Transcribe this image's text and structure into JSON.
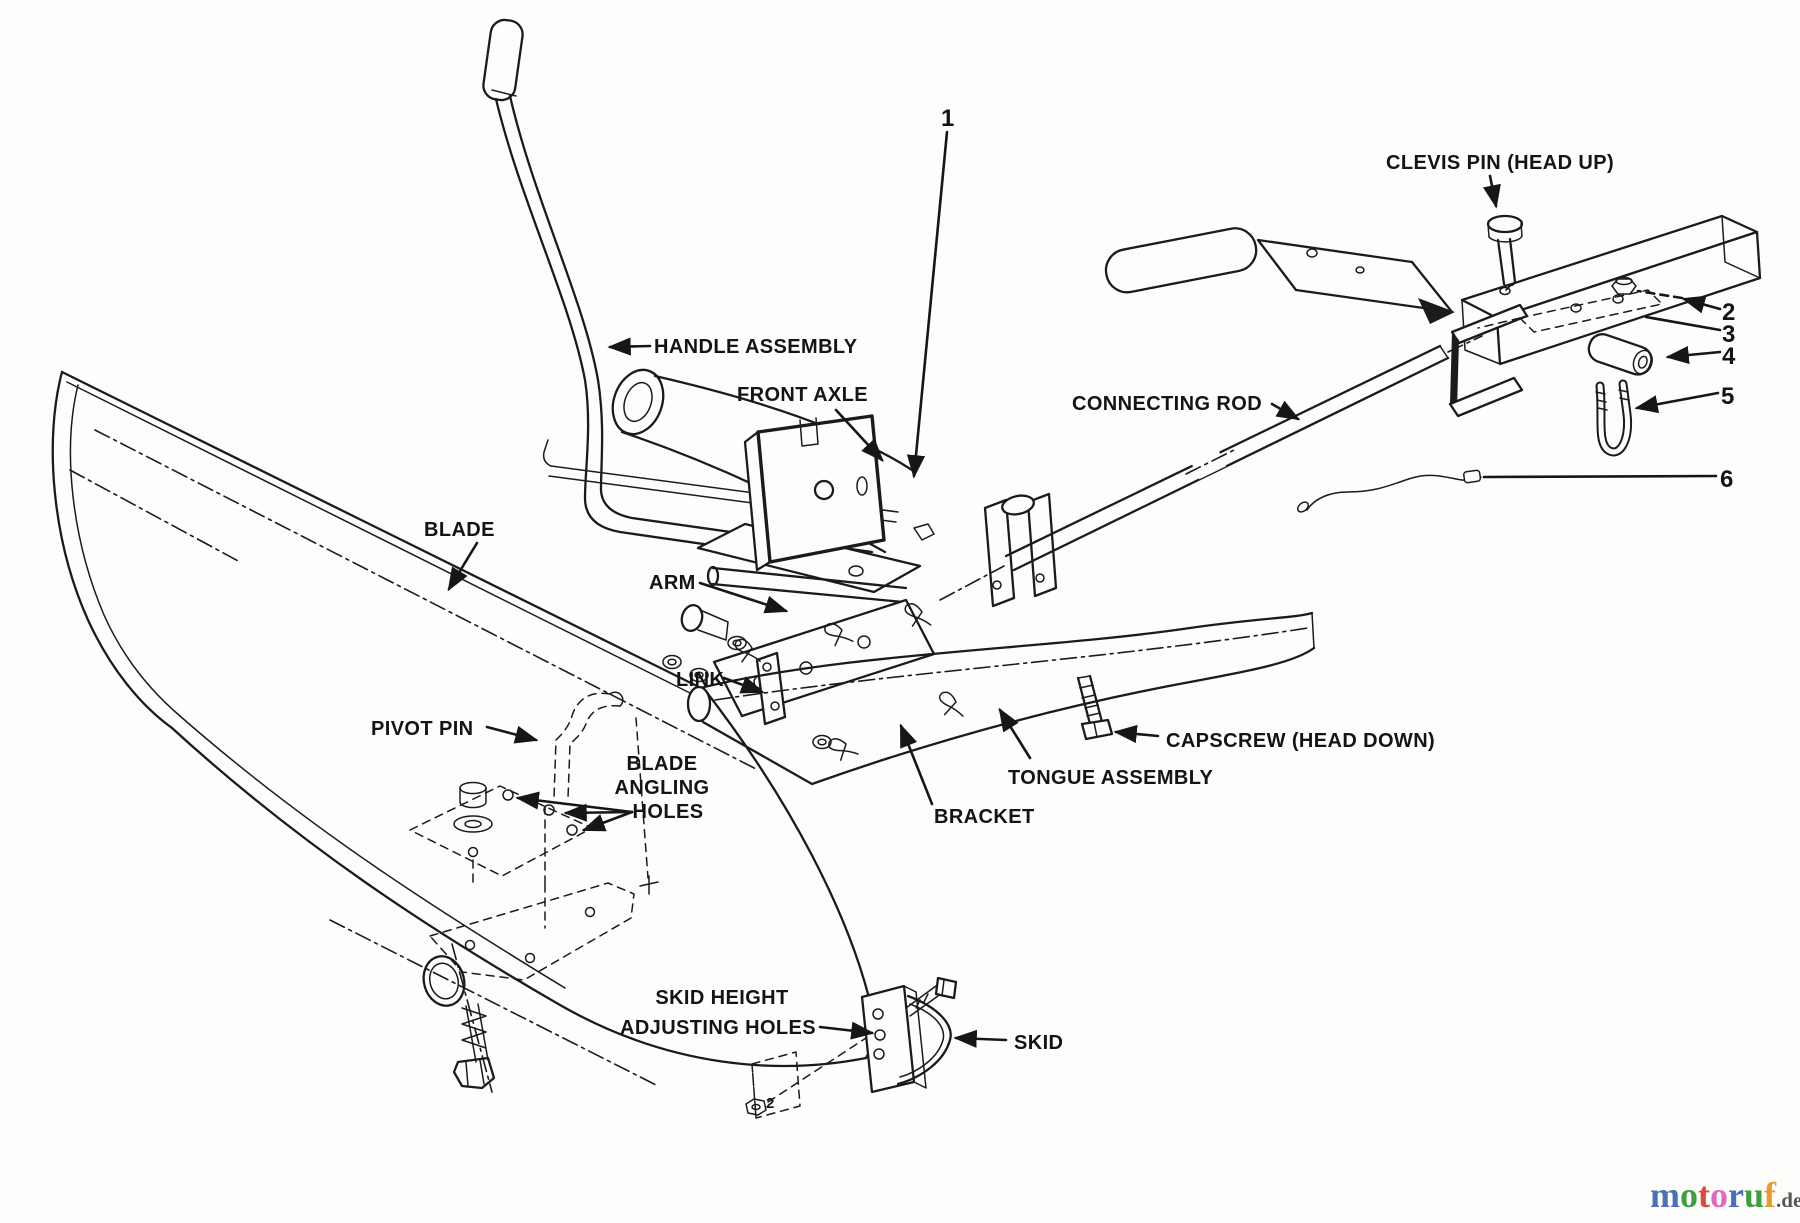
{
  "labels": {
    "clevis_pin": "CLEVIS PIN (HEAD UP)",
    "handle_assembly": "HANDLE ASSEMBLY",
    "front_axle": "FRONT AXLE",
    "connecting_rod": "CONNECTING ROD",
    "blade": "BLADE",
    "arm": "ARM",
    "link": "LINK",
    "pivot_pin": "PIVOT PIN",
    "blade_angling_holes": {
      "line1": "BLADE",
      "line2": "ANGLING",
      "line3": "HOLES"
    },
    "skid_height_adjusting_holes": {
      "line1": "SKID HEIGHT",
      "line2": "ADJUSTING HOLES"
    },
    "skid": "SKID",
    "tongue_assembly": "TONGUE ASSEMBLY",
    "bracket": "BRACKET",
    "capscrew": "CAPSCREW (HEAD DOWN)"
  },
  "callouts": {
    "c1": "1",
    "c2": "2",
    "c3": "3",
    "c4": "4",
    "c5": "5",
    "c6": "6",
    "skid_nut": "2"
  },
  "watermark": {
    "letters": [
      "m",
      "o",
      "t",
      "o",
      "r",
      "u",
      "f"
    ],
    "colors": [
      "#4a71b8",
      "#3f9e3f",
      "#d94a3a",
      "#e168c0",
      "#4a71b8",
      "#3f9e3f",
      "#e89b2e"
    ],
    "suffix": ".de",
    "suffix_color": "#555555"
  }
}
